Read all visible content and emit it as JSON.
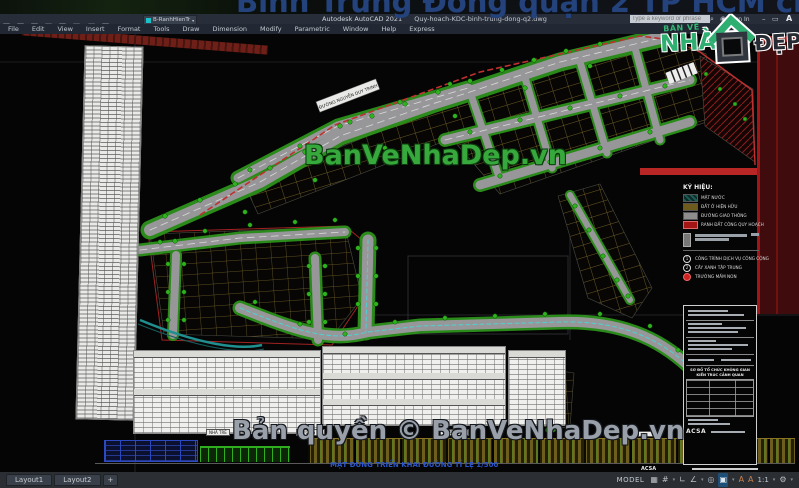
{
  "window": {
    "app_title": "Autodesk AutoCAD 2021",
    "doc_title": "Quy-hoach-KDC-binh-trung-dong-q2.dwg",
    "search_placeholder": "Type a keyword or phrase",
    "sign_in_label": "Sign In",
    "layer_combo_value": "B-RanhHienTr",
    "autodesk_mark": "A",
    "quick_icons": [
      "new",
      "open",
      "save",
      "save-as",
      "plot",
      "undo",
      "redo",
      "workspace"
    ]
  },
  "menus": [
    "File",
    "Edit",
    "View",
    "Insert",
    "Format",
    "Tools",
    "Draw",
    "Dimension",
    "Modify",
    "Parametric",
    "Window",
    "Help",
    "Express"
  ],
  "watermarks": {
    "top": "Bình Trưng Đông quận 2 TP HCM chi tiết",
    "center": "BanVeNhaDep.vn",
    "bottom": "Bản quyền © BanVeNhaDep.vn"
  },
  "brand_logo": {
    "top": "BẢN VẼ",
    "main": "NHÀ",
    "suffix": "ĐẸP"
  },
  "plan": {
    "road_label": "ĐƯỜNG NGUYỄN DUY TRINH",
    "elevation_labels": [
      "NHÀ TRẺ",
      "ĐƯỜNG D1",
      "ĐƯỜNG D2"
    ],
    "elevation_caption": "MẶT ĐỨNG TRIỂN KHAI ĐƯỜNG TỈ LỆ 1/500"
  },
  "legend": {
    "title": "KÝ HIỆU:",
    "items": [
      {
        "label": "MẶT NƯỚC",
        "swatch": "#1c5c55"
      },
      {
        "label": "ĐẤT Ở HIỆN HỮU",
        "swatch": "#6e5a1c"
      },
      {
        "label": "ĐƯỜNG GIAO THÔNG",
        "swatch": "#8d8d8d"
      },
      {
        "label": "RANH ĐẤT CÔNG QUY HOẠCH",
        "swatch": "#a31515"
      }
    ],
    "symbols": [
      {
        "mark": "1",
        "label": "CÔNG TRÌNH DỊCH VỤ CÔNG CỘNG"
      },
      {
        "mark": "2",
        "label": "CÂY XANH TẬP TRUNG"
      },
      {
        "mark": "",
        "label": "TRƯỜNG MẦM NON"
      }
    ]
  },
  "titleblock": {
    "scheme_title": "SƠ ĐỒ TỔ CHỨC KHÔNG GIAN KIẾN TRÚC CẢNH QUAN",
    "logo": "ACSA"
  },
  "statusbar": {
    "model": "MODEL",
    "scale": "1:1",
    "icons": {
      "grid": "▦",
      "snap": "#",
      "ortho": "∟",
      "polar": "∠",
      "osnap": "◎",
      "isodraft": "▣",
      "annotation": "A",
      "annoscale": "A",
      "gear": "⚙"
    }
  },
  "layout_tabs": [
    "Layout1",
    "Layout2",
    "+"
  ],
  "colors": {
    "watermark_blue": "#24427c",
    "watermark_green": "#37a93c",
    "watermark_gray": "#99a0aa",
    "boundary_red": "#c03030",
    "road_gray": "#97979a",
    "tree_green": "#2eb31e",
    "parcel_yellow": "#9c8434",
    "water_teal": "#1f8f8f",
    "titlebar_bg": "#272e3a"
  }
}
